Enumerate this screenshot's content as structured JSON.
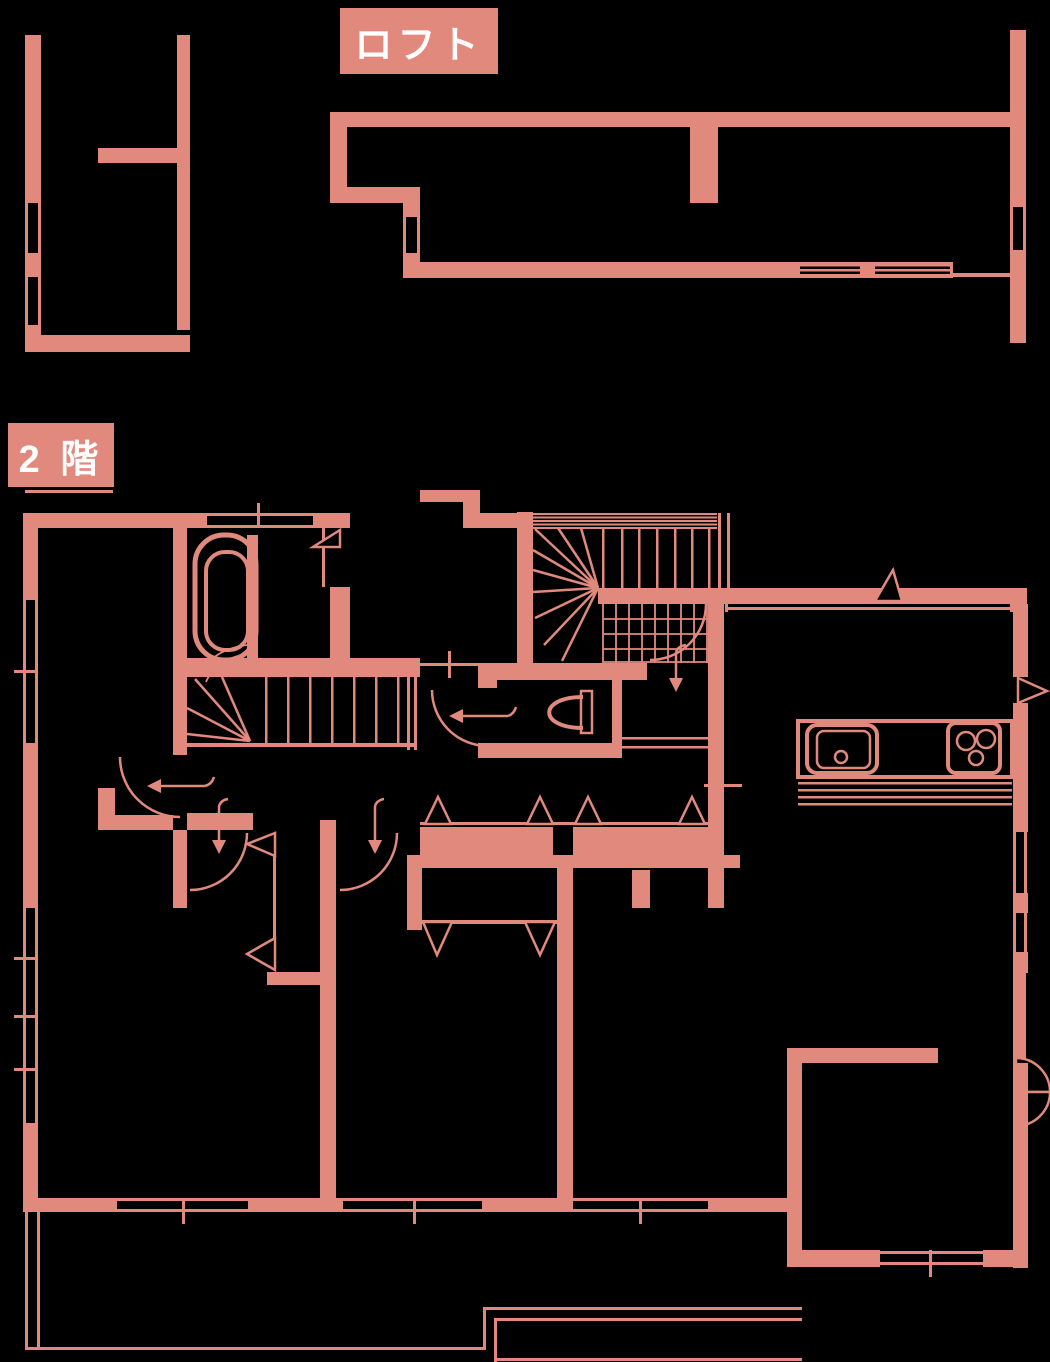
{
  "page": {
    "kind": "floor-plan"
  },
  "labels": {
    "loft": "ロフト",
    "second_floor": "2 階"
  },
  "colors": {
    "wall": "#e2897e",
    "background": "#000000",
    "label_text": "#ffffff"
  },
  "fixtures": {
    "bathtub": "bathtub",
    "toilet": "toilet",
    "kitchen_sink": "kitchen-sink",
    "stove": "stove-3-burner",
    "stairs_upper": "winder-staircase-up",
    "stairs_lower": "winder-staircase-down"
  }
}
